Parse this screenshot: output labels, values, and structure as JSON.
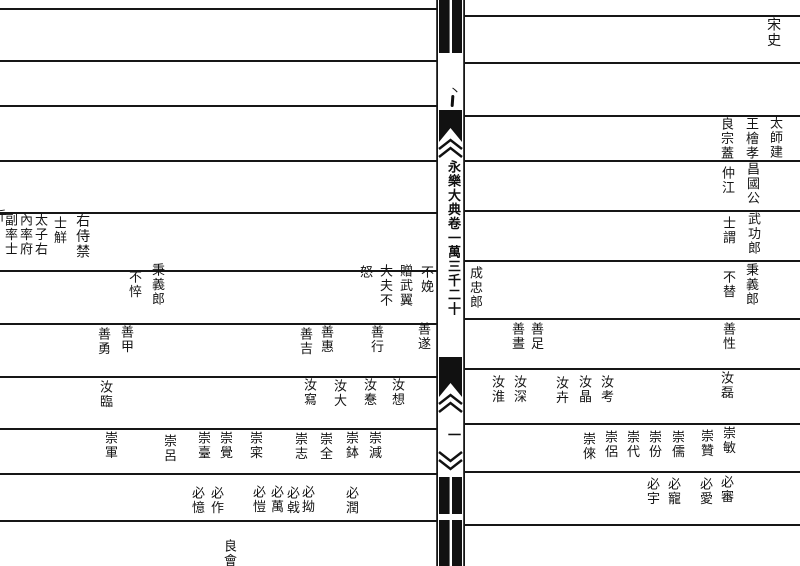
{
  "colors": {
    "paper": "#ffffff",
    "ink": "#151515"
  },
  "spine": {
    "title": "永樂大典卷一萬三千二十",
    "page_number": "一",
    "mark": "丶"
  },
  "right_page": {
    "entries": [
      {
        "text": "宋史",
        "x": 765,
        "y": 17,
        "size": 14
      },
      {
        "text": "太師建",
        "x": 767,
        "y": 116
      },
      {
        "text": "王檜孝",
        "x": 743,
        "y": 117
      },
      {
        "text": "良宗蓋",
        "x": 718,
        "y": 117
      },
      {
        "text": "昌國公",
        "x": 744,
        "y": 162
      },
      {
        "text": "仲江",
        "x": 719,
        "y": 166
      },
      {
        "text": "武功郎",
        "x": 745,
        "y": 212
      },
      {
        "text": "士謂",
        "x": 720,
        "y": 216
      },
      {
        "text": "成忠郎",
        "x": 467,
        "y": 266
      },
      {
        "text": "秉義郎",
        "x": 743,
        "y": 263
      },
      {
        "text": "不替",
        "x": 720,
        "y": 270
      },
      {
        "text": "善性",
        "x": 720,
        "y": 322
      },
      {
        "text": "善足",
        "x": 528,
        "y": 322
      },
      {
        "text": "善晝",
        "x": 509,
        "y": 322
      },
      {
        "text": "汝磊",
        "x": 718,
        "y": 371
      },
      {
        "text": "汝考",
        "x": 598,
        "y": 375
      },
      {
        "text": "汝晶",
        "x": 576,
        "y": 375
      },
      {
        "text": "汝卉",
        "x": 553,
        "y": 376
      },
      {
        "text": "汝深",
        "x": 511,
        "y": 375
      },
      {
        "text": "汝淮",
        "x": 489,
        "y": 375
      },
      {
        "text": "崇敏",
        "x": 720,
        "y": 426
      },
      {
        "text": "崇贊",
        "x": 698,
        "y": 429
      },
      {
        "text": "崇儒",
        "x": 669,
        "y": 430
      },
      {
        "text": "崇份",
        "x": 646,
        "y": 430
      },
      {
        "text": "崇代",
        "x": 624,
        "y": 430
      },
      {
        "text": "崇侶",
        "x": 602,
        "y": 430
      },
      {
        "text": "崇倈",
        "x": 580,
        "y": 432
      },
      {
        "text": "必審",
        "x": 718,
        "y": 475
      },
      {
        "text": "必愛",
        "x": 697,
        "y": 477
      },
      {
        "text": "必寵",
        "x": 665,
        "y": 477
      },
      {
        "text": "必宇",
        "x": 644,
        "y": 477
      }
    ]
  },
  "left_page": {
    "entries": [
      {
        "text": "右侍禁",
        "x": 74,
        "y": 213,
        "size": 14
      },
      {
        "text": "士觧",
        "x": 51,
        "y": 216
      },
      {
        "text": "太子右",
        "x": 32,
        "y": 213
      },
      {
        "text": "內率府",
        "x": 17,
        "y": 213
      },
      {
        "text": "副率士",
        "x": 2,
        "y": 213
      },
      {
        "text": "斤",
        "x": -9,
        "y": 209
      },
      {
        "text": "秉義郎",
        "x": 149,
        "y": 263
      },
      {
        "text": "不悴",
        "x": 126,
        "y": 270
      },
      {
        "text": "不娩",
        "x": 418,
        "y": 265
      },
      {
        "text": "贈武翼",
        "x": 397,
        "y": 264
      },
      {
        "text": "大夫不",
        "x": 377,
        "y": 264
      },
      {
        "text": "怒",
        "x": 357,
        "y": 265
      },
      {
        "text": "善遂",
        "x": 415,
        "y": 322
      },
      {
        "text": "善行",
        "x": 368,
        "y": 325
      },
      {
        "text": "善惠",
        "x": 318,
        "y": 325
      },
      {
        "text": "善吉",
        "x": 297,
        "y": 327
      },
      {
        "text": "善甲",
        "x": 118,
        "y": 325
      },
      {
        "text": "善勇",
        "x": 95,
        "y": 327
      },
      {
        "text": "汝想",
        "x": 389,
        "y": 378
      },
      {
        "text": "汝惷",
        "x": 361,
        "y": 378
      },
      {
        "text": "汝大",
        "x": 331,
        "y": 379
      },
      {
        "text": "汝寫",
        "x": 301,
        "y": 378
      },
      {
        "text": "汝臨",
        "x": 97,
        "y": 380
      },
      {
        "text": "崇減",
        "x": 366,
        "y": 431
      },
      {
        "text": "崇鉢",
        "x": 343,
        "y": 431
      },
      {
        "text": "崇全",
        "x": 317,
        "y": 432
      },
      {
        "text": "崇志",
        "x": 292,
        "y": 432
      },
      {
        "text": "崇寀",
        "x": 247,
        "y": 431
      },
      {
        "text": "崇覺",
        "x": 217,
        "y": 431
      },
      {
        "text": "崇臺",
        "x": 195,
        "y": 431
      },
      {
        "text": "崇呂",
        "x": 161,
        "y": 434
      },
      {
        "text": "崇軍",
        "x": 102,
        "y": 431
      },
      {
        "text": "必潤",
        "x": 343,
        "y": 486
      },
      {
        "text": "必拗",
        "x": 299,
        "y": 485
      },
      {
        "text": "必㦸",
        "x": 284,
        "y": 486
      },
      {
        "text": "必萬",
        "x": 268,
        "y": 485
      },
      {
        "text": "必愷",
        "x": 250,
        "y": 485
      },
      {
        "text": "必作",
        "x": 208,
        "y": 486
      },
      {
        "text": "必憶",
        "x": 189,
        "y": 486
      },
      {
        "text": "良會",
        "x": 221,
        "y": 539
      }
    ]
  },
  "layout": {
    "left_lines": {
      "x": 0,
      "width": 437,
      "ys": [
        8,
        60,
        105,
        160,
        212,
        270,
        323,
        376,
        428,
        473,
        520
      ]
    },
    "right_lines": {
      "x": 465,
      "width": 335,
      "ys": [
        15,
        62,
        115,
        160,
        210,
        260,
        318,
        368,
        423,
        471,
        524
      ]
    }
  }
}
